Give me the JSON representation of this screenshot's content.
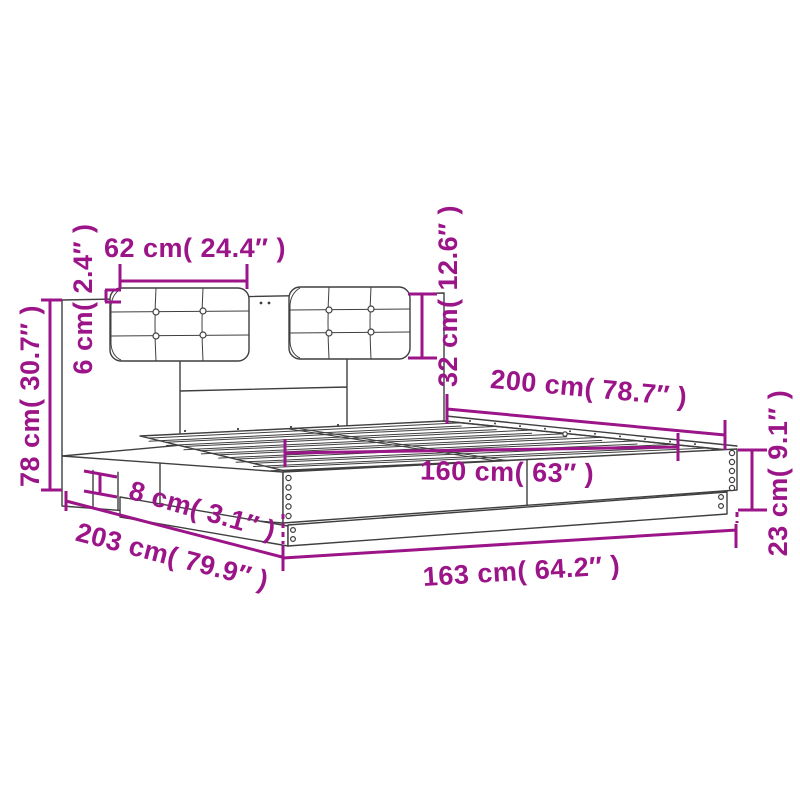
{
  "diagram": {
    "kind": "product dimension diagram",
    "subject": "bed frame with headboard and two tufted cushions",
    "colors": {
      "dimension_accent": "#9B1488",
      "linework": "#3F3F3F",
      "background": "#FFFFFF"
    },
    "dimensions": {
      "cushion_width": "62 cm( 24.4″ )",
      "cushion_thickness": "6 cm( 2.4″ )",
      "headboard_height": "78 cm( 30.7″ )",
      "cushion_height": "32 cm( 12.6″ )",
      "slat_area_length": "200 cm( 78.7″ )",
      "slat_area_width": "160 cm( 63″ )",
      "side_rail_height": "8 cm( 3.1″ )",
      "total_length": "203 cm( 79.9″ )",
      "total_width": "163 cm( 64.2″ )",
      "frame_height": "23 cm( 9.1″ )"
    }
  }
}
